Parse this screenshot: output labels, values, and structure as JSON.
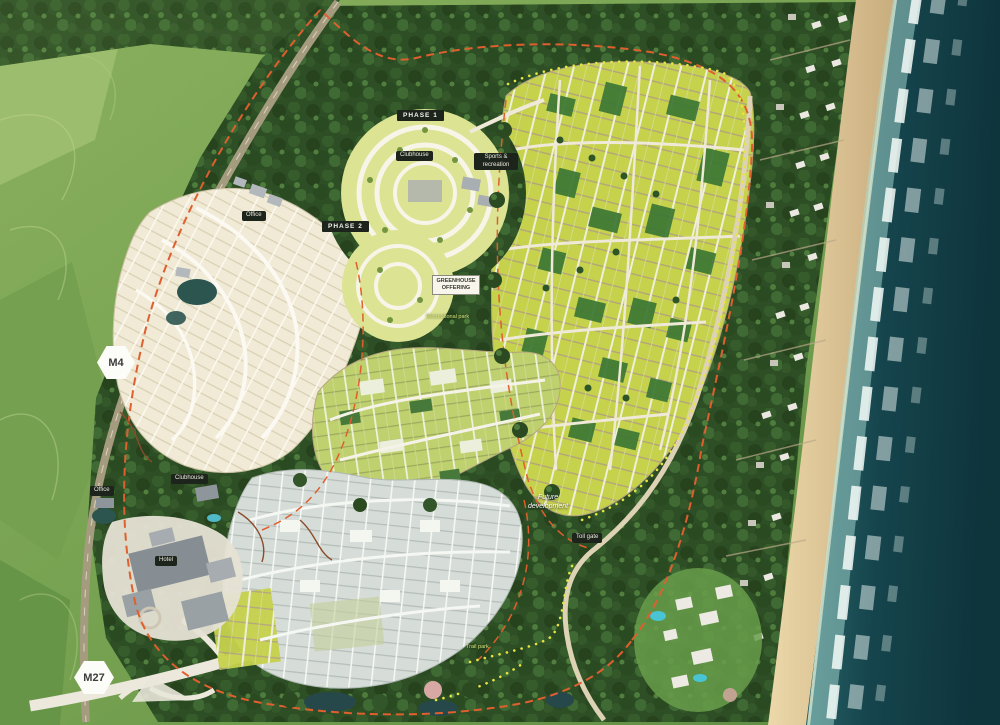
{
  "markers": {
    "m4": "M4",
    "m27": "M27"
  },
  "phases": {
    "phase1": "PHASE 1",
    "phase2": "PHASE 2"
  },
  "labels": {
    "clubhouse_north": "Clubhouse",
    "office_north": "Office",
    "sports": "Sports & recreation",
    "greenhouse_l1": "Greenhouse",
    "greenhouse_l2": "offering",
    "recreation_trail": "Recreational park",
    "future_l1": "Future",
    "future_l2": "development",
    "toll_gate": "Toll gate",
    "clubhouse_south": "Clubhouse",
    "office_south": "Office",
    "hotel": "Hotel",
    "trail_park": "Trail park"
  },
  "colors": {
    "label-bg": "#1d241c",
    "boundary": "#df5f2e",
    "trail": "#e8e43f",
    "ocean-deep": "#0e343c",
    "ocean-shallow": "#2e6f72",
    "sand": "#e2cba0",
    "forest": "#2e4f26",
    "plots-yellow": "#c6d14c",
    "plots-green": "#3c7734",
    "plots-cream": "#f0ead6",
    "plots-grey": "#d6dcd8"
  }
}
